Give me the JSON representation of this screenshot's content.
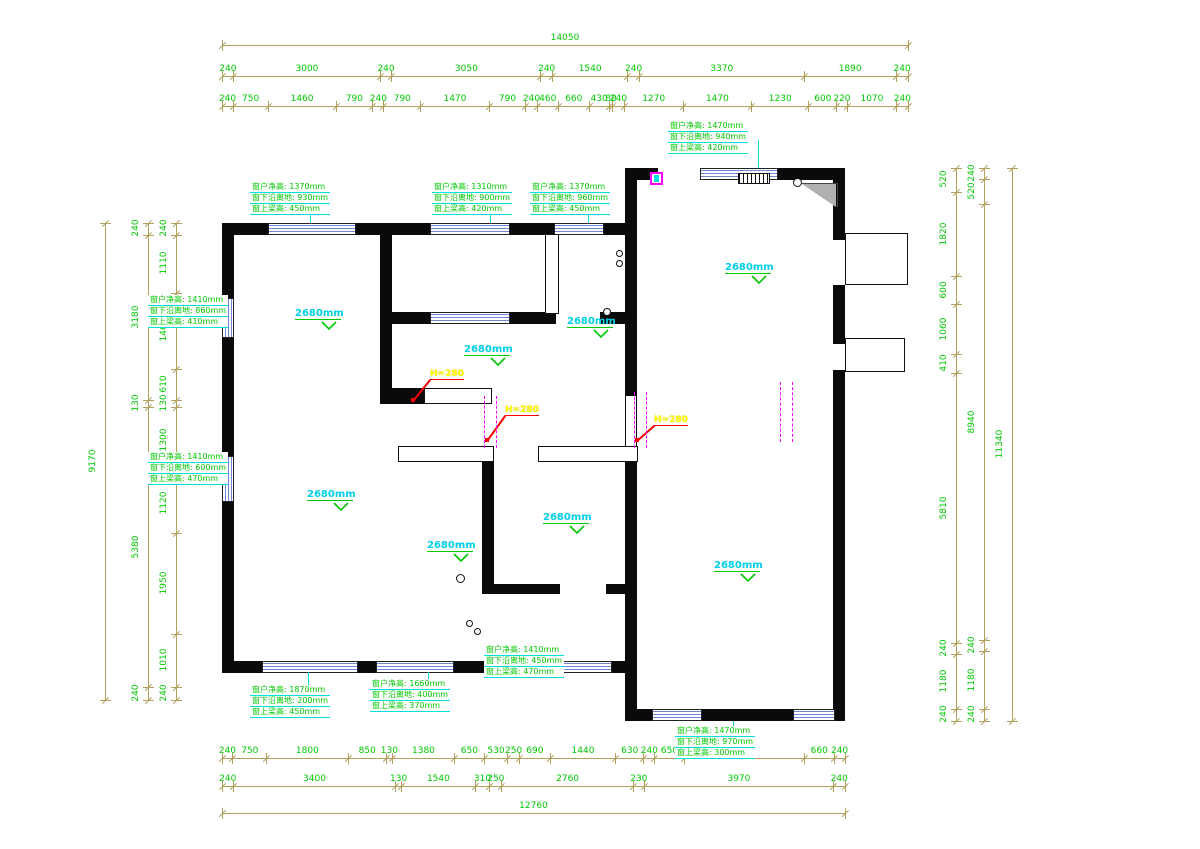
{
  "title": "apartment-floor-plan-cad-drawing",
  "colors": {
    "dim_line": "#b3a05f",
    "dim_text": "#00c800",
    "wall": "#0a0a0a",
    "window_stripe": "#7286d8",
    "spec_text": "#00c800",
    "spec_underline": "#00e0e0",
    "ceiling_text": "#00cfe8",
    "step_text": "#ffff00",
    "step_leader": "#ff0000",
    "door_dash": "#ff00ff"
  },
  "dim_rows": [
    {
      "name": "top-total",
      "orient": "h",
      "x": 222,
      "y": 45,
      "len": 686,
      "values": [
        "14050"
      ]
    },
    {
      "name": "top-major",
      "orient": "h",
      "x": 222,
      "y": 76,
      "len": 686,
      "values": [
        "240",
        "3000",
        "240",
        "3050",
        "240",
        "1540",
        "240",
        "3370",
        "1890",
        "240"
      ]
    },
    {
      "name": "top-minor",
      "orient": "h",
      "x": 222,
      "y": 106,
      "len": 686,
      "values": [
        "240",
        "750",
        "1460",
        "790",
        "240",
        "790",
        "1470",
        "790",
        "240",
        "460",
        "660",
        "430",
        "80",
        "240",
        "1270",
        "1470",
        "1230",
        "600",
        "220",
        "1070",
        "240"
      ]
    },
    {
      "name": "left-total",
      "orient": "v",
      "x": 105,
      "y": 223,
      "len": 477,
      "values": [
        "9170"
      ]
    },
    {
      "name": "left-major",
      "orient": "v",
      "x": 148,
      "y": 223,
      "len": 477,
      "values": [
        "240",
        "3180",
        "130",
        "5380",
        "240"
      ]
    },
    {
      "name": "left-minor",
      "orient": "v",
      "x": 176,
      "y": 223,
      "len": 477,
      "values": [
        "240",
        "1110",
        "1460",
        "610",
        "130",
        "1300",
        "1120",
        "1950",
        "1010",
        "240"
      ]
    },
    {
      "name": "right-minor",
      "orient": "v",
      "x": 956,
      "y": 168,
      "len": 553,
      "values": [
        "520",
        "1820",
        "600",
        "1060",
        "410",
        "5810",
        "240",
        "1180",
        "240"
      ]
    },
    {
      "name": "right-major",
      "orient": "v",
      "x": 984,
      "y": 168,
      "len": 553,
      "values": [
        "240",
        "520",
        "8940",
        "240",
        "1180",
        "240"
      ]
    },
    {
      "name": "right-total",
      "orient": "v",
      "x": 1012,
      "y": 168,
      "len": 553,
      "values": [
        "11340"
      ]
    },
    {
      "name": "bottom-minor",
      "orient": "h",
      "x": 222,
      "y": 758,
      "len": 623,
      "values": [
        "240",
        "750",
        "1800",
        "850",
        "130",
        "1380",
        "650",
        "530",
        "250",
        "690",
        "1440",
        "630",
        "240",
        "650",
        "2660",
        "660",
        "240"
      ]
    },
    {
      "name": "bottom-major",
      "orient": "h",
      "x": 222,
      "y": 786,
      "len": 623,
      "values": [
        "240",
        "3400",
        "130",
        "1540",
        "310",
        "250",
        "2760",
        "230",
        "3970",
        "240"
      ]
    },
    {
      "name": "bottom-total",
      "orient": "h",
      "x": 222,
      "y": 813,
      "len": 623,
      "values": [
        "12760"
      ]
    }
  ],
  "window_specs": [
    {
      "x": 668,
      "y": 121,
      "lines": [
        "窗户净高: 1470mm",
        "窗下沿离地: 940mm",
        "窗上梁高: 420mm"
      ]
    },
    {
      "x": 250,
      "y": 182,
      "lines": [
        "窗户净高: 1370mm",
        "窗下沿离地: 930mm",
        "窗上梁高: 450mm"
      ]
    },
    {
      "x": 432,
      "y": 182,
      "lines": [
        "窗户净高: 1310mm",
        "窗下沿离地: 900mm",
        "窗上梁高: 420mm"
      ]
    },
    {
      "x": 530,
      "y": 182,
      "lines": [
        "窗户净高: 1370mm",
        "窗下沿离地: 960mm",
        "窗上梁高: 450mm"
      ]
    },
    {
      "x": 148,
      "y": 295,
      "lines": [
        "窗户净高: 1410mm",
        "窗下沿离地: 860mm",
        "窗上梁高: 410mm"
      ]
    },
    {
      "x": 148,
      "y": 452,
      "lines": [
        "窗户净高: 1410mm",
        "窗下沿离地: 600mm",
        "窗上梁高: 470mm"
      ]
    },
    {
      "x": 250,
      "y": 685,
      "lines": [
        "窗户净高: 1870mm",
        "窗下沿离地: 200mm",
        "窗上梁高: 450mm"
      ]
    },
    {
      "x": 370,
      "y": 679,
      "lines": [
        "窗户净高: 1660mm",
        "窗下沿离地: 400mm",
        "窗上梁高: 370mm"
      ]
    },
    {
      "x": 484,
      "y": 645,
      "lines": [
        "窗户净高: 1410mm",
        "窗下沿离地: 450mm",
        "窗上梁高: 470mm"
      ]
    },
    {
      "x": 675,
      "y": 726,
      "lines": [
        "窗户净高: 1470mm",
        "窗下沿离地: 970mm",
        "窗上梁高: 300mm"
      ]
    }
  ],
  "spec_leaders": [
    {
      "x": 758,
      "y1": 140,
      "y2": 168
    },
    {
      "x": 310,
      "y1": 201,
      "y2": 223
    },
    {
      "x": 490,
      "y1": 201,
      "y2": 223
    },
    {
      "x": 588,
      "y1": 201,
      "y2": 223
    },
    {
      "x": 308,
      "y1": 672,
      "y2": 685
    },
    {
      "x": 428,
      "y1": 672,
      "y2": 679
    },
    {
      "x": 540,
      "y1": 648,
      "y2": 661
    },
    {
      "x": 733,
      "y1": 721,
      "y2": 726
    }
  ],
  "ceiling_labels": [
    {
      "text": "2680mm",
      "x": 295,
      "y": 308
    },
    {
      "text": "2680mm",
      "x": 567,
      "y": 316
    },
    {
      "text": "2680mm",
      "x": 464,
      "y": 344
    },
    {
      "text": "2680mm",
      "x": 725,
      "y": 262
    },
    {
      "text": "2680mm",
      "x": 307,
      "y": 489
    },
    {
      "text": "2680mm",
      "x": 543,
      "y": 512
    },
    {
      "text": "2680mm",
      "x": 427,
      "y": 540
    },
    {
      "text": "2680mm",
      "x": 714,
      "y": 560
    }
  ],
  "step_labels": [
    {
      "text": "H=280",
      "x": 430,
      "y": 369,
      "ax": 413,
      "ay": 400
    },
    {
      "text": "H=280",
      "x": 505,
      "y": 405,
      "ax": 487,
      "ay": 440
    },
    {
      "text": "H=280",
      "x": 654,
      "y": 415,
      "ax": 637,
      "ay": 440
    }
  ],
  "door_dashes": [
    {
      "x1": 484,
      "x2": 496,
      "y": 396,
      "h": 52
    },
    {
      "x1": 634,
      "x2": 646,
      "y": 392,
      "h": 56
    },
    {
      "x1": 780,
      "x2": 792,
      "y": 382,
      "h": 60
    }
  ],
  "plan": {
    "walls": [
      [
        222,
        223,
        415,
        12
      ],
      [
        222,
        223,
        12,
        450
      ],
      [
        222,
        661,
        415,
        12
      ],
      [
        625,
        168,
        220,
        12
      ],
      [
        833,
        168,
        12,
        553
      ],
      [
        625,
        709,
        220,
        12
      ],
      [
        625,
        168,
        12,
        553
      ],
      [
        380,
        234,
        12,
        166
      ],
      [
        392,
        312,
        238,
        12
      ],
      [
        482,
        448,
        12,
        146
      ],
      [
        482,
        584,
        148,
        10
      ],
      [
        380,
        388,
        46,
        16
      ]
    ],
    "beams": [
      [
        424,
        388,
        68,
        16
      ],
      [
        398,
        446,
        96,
        16
      ],
      [
        538,
        446,
        100,
        16
      ],
      [
        545,
        234,
        14,
        80
      ],
      [
        845,
        233,
        63,
        52
      ],
      [
        845,
        338,
        60,
        34
      ]
    ],
    "windows_h": [
      [
        268,
        223,
        88,
        12
      ],
      [
        430,
        223,
        80,
        12
      ],
      [
        554,
        223,
        50,
        12
      ],
      [
        700,
        168,
        78,
        12
      ],
      [
        262,
        661,
        96,
        12
      ],
      [
        376,
        661,
        78,
        12
      ],
      [
        560,
        661,
        52,
        12
      ],
      [
        652,
        709,
        50,
        12
      ],
      [
        793,
        709,
        42,
        12
      ],
      [
        430,
        312,
        80,
        12
      ]
    ],
    "windows_v": [
      [
        222,
        298,
        12,
        40
      ],
      [
        222,
        456,
        12,
        46
      ]
    ],
    "openings": [
      [
        658,
        168,
        42,
        12
      ],
      [
        833,
        240,
        12,
        45
      ],
      [
        833,
        344,
        12,
        26
      ],
      [
        626,
        396,
        10,
        52
      ],
      [
        556,
        312,
        44,
        12
      ],
      [
        496,
        661,
        58,
        12
      ],
      [
        560,
        584,
        46,
        10
      ]
    ],
    "fixtures": {
      "socket_symbol": {
        "x": 650,
        "y": 172,
        "w": 13,
        "h": 13
      },
      "vent_grille": {
        "x": 738,
        "y": 173,
        "w": 32,
        "h": 11
      },
      "shower_corner": {
        "x": 802,
        "y": 183,
        "w": 36,
        "h": 24
      },
      "circles": [
        [
          793,
          178,
          9
        ],
        [
          603,
          308,
          8
        ],
        [
          456,
          574,
          9
        ],
        [
          466,
          620,
          7
        ],
        [
          474,
          628,
          7
        ],
        [
          616,
          250,
          7
        ],
        [
          616,
          260,
          7
        ]
      ]
    }
  }
}
